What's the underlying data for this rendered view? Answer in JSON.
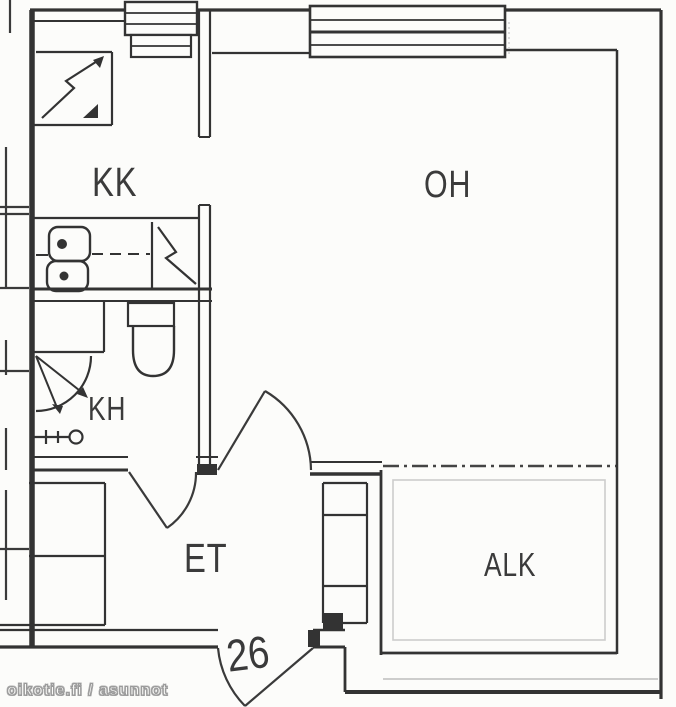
{
  "floorplan": {
    "rooms": {
      "kk": {
        "label": "KK"
      },
      "oh": {
        "label": "OH"
      },
      "kh": {
        "label": "KH"
      },
      "et": {
        "label": "ET"
      },
      "alk": {
        "label": "ALK"
      }
    },
    "apartment_number": "26",
    "watermark": "oikotie.fi / asunnot",
    "colors": {
      "background": "#fcfcfa",
      "wall": "#333333",
      "wall_light": "#bdbdbd",
      "label": "#3b3b3b",
      "watermark_outline": "#9a9a9a"
    },
    "icons": [
      "window-icon",
      "door-swing-icon",
      "toilet-icon",
      "shower-icon",
      "faucet-icon",
      "double-sink-icon",
      "appliance-icon",
      "wardrobe-icon"
    ]
  }
}
